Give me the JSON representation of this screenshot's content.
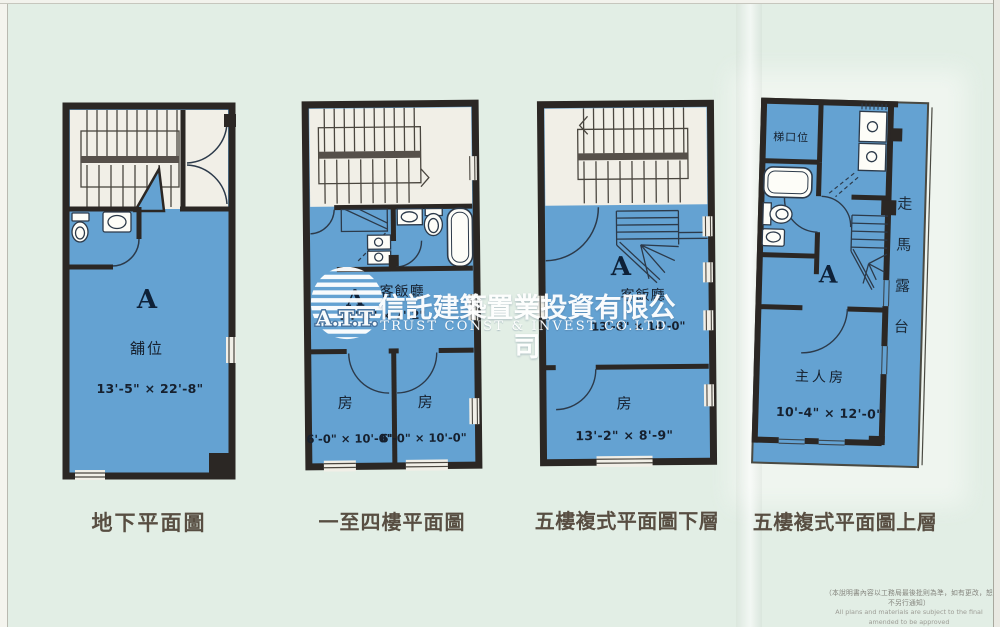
{
  "watermark": {
    "logo_text": "A.T.T.",
    "company_zh": "信託建築置業投資有限公司",
    "company_en": "TRUST CONST & INVEST CO.LTD."
  },
  "footnote": {
    "zh": "（本說明書內容以工務局最後批則為準，如有更改，恕不另行通知）",
    "en": "All plans and materials are subject to the final amended to be approved"
  },
  "plans": {
    "ground": {
      "caption": "地下平面圖",
      "unit": "A",
      "room": "舖位",
      "dim": "13'-5\" × 22'-8\""
    },
    "typical": {
      "caption": "一至四樓平面圖",
      "unit": "A",
      "living": "客飯廳",
      "living_dim": "14'-0\" × 7'-2\"",
      "bed1": "房",
      "bed1_dim": "6'-0\" × 10'-0\"",
      "bed2": "房",
      "bed2_dim": "6'-0\" × 10'-0\""
    },
    "duplex_lower": {
      "caption": "五樓複式平面圖下層",
      "unit": "A",
      "living": "客飯廳",
      "living_dim": "13'-8\" × 14'-0\"",
      "bed": "房",
      "bed_dim": "13'-2\" × 8'-9\""
    },
    "duplex_upper": {
      "caption": "五樓複式平面圖上層",
      "unit": "A",
      "stair_hall": "梯口位",
      "master": "主人房",
      "master_dim": "10'-4\" × 12'-0\"",
      "balcony": "走馬露台"
    }
  }
}
